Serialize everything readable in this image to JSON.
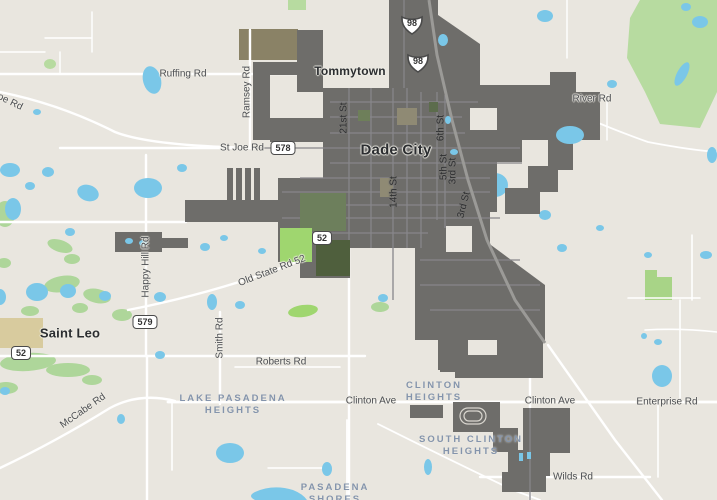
{
  "title": "Dade City area street map",
  "colors": {
    "land": "#e9e6df",
    "water": "#7ac7e8",
    "city_limits_fill": "#6e6d6a",
    "city_inner_road": "#87868a",
    "outside_road": "#ffffff",
    "forest_green": "#b7dba0",
    "park_bright_green": "#9fd66f",
    "dark_green": "#5c6c4a",
    "campus_tan": "#d8cb9e",
    "road_label": "#4c4e52",
    "town_label": "#2b2d30",
    "neighborhood_label": "#8494ac"
  },
  "places": {
    "dade_city": {
      "label": "Dade City"
    },
    "tommytown": {
      "label": "Tommytown"
    },
    "saint_leo": {
      "label": "Saint Leo"
    }
  },
  "roads": {
    "ruffing": {
      "label": "Ruffing Rd"
    },
    "ramsey": {
      "label": "Ramsey Rd"
    },
    "st_joe": {
      "label": "St Joe Rd"
    },
    "st_joe_corner": {
      "label": "oe Rd"
    },
    "river": {
      "label": "River Rd"
    },
    "happy_hill": {
      "label": "Happy Hill Rd"
    },
    "old_state_52": {
      "label": "Old State Rd 52"
    },
    "mccabe": {
      "label": "McCabe Rd"
    },
    "smith": {
      "label": "Smith Rd"
    },
    "roberts": {
      "label": "Roberts Rd"
    },
    "clinton_west": {
      "label": "Clinton Ave"
    },
    "clinton_east": {
      "label": "Clinton Ave"
    },
    "wilds": {
      "label": "Wilds Rd"
    },
    "enterprise": {
      "label": "Enterprise Rd"
    },
    "st_21": {
      "label": "21st St"
    },
    "st_14": {
      "label": "14th St"
    },
    "st_6": {
      "label": "6th St"
    },
    "st_5": {
      "label": "5th St"
    },
    "st_3a": {
      "label": "3rd St"
    },
    "st_3b": {
      "label": "3rd St"
    }
  },
  "neighborhoods": {
    "lake_pasadena": {
      "line1": "LAKE PASADENA",
      "line2": "HEIGHTS"
    },
    "clinton_heights": {
      "line1": "CLINTON",
      "line2": "HEIGHTS"
    },
    "south_clinton": {
      "line1": "SOUTH CLINTON",
      "line2": "HEIGHTS"
    },
    "pasadena_shores": {
      "line1": "PASADENA",
      "line2": "SHORES"
    }
  },
  "shields": {
    "us98_north": {
      "label": "98"
    },
    "us98_south": {
      "label": "98"
    },
    "sr578": {
      "label": "578"
    },
    "sr579": {
      "label": "579"
    },
    "sr52_east": {
      "label": "52"
    },
    "sr52_west": {
      "label": "52"
    }
  }
}
